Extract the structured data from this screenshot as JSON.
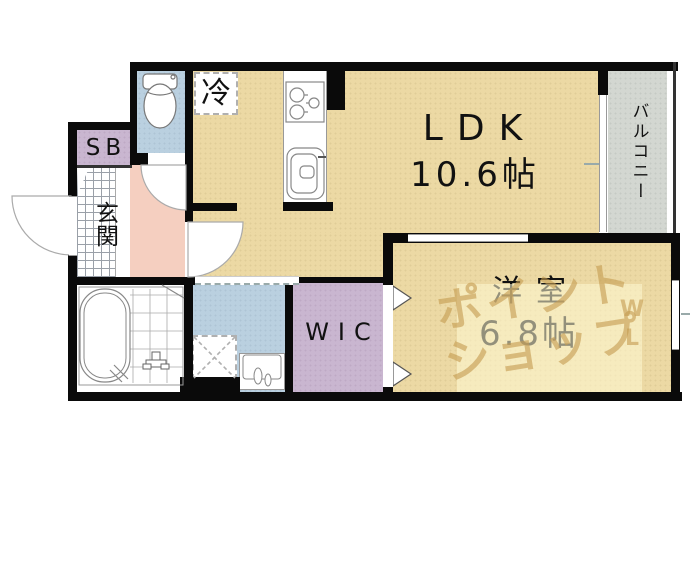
{
  "plan": {
    "rooms": {
      "ldk": {
        "label": "LDK",
        "area": "10.6帖"
      },
      "bedroom": {
        "label": "洋室",
        "area": "6.8帖"
      },
      "balcony": {
        "label": "バルコニー"
      },
      "wic": {
        "label": "WIC"
      },
      "entrance": {
        "label": "玄関"
      },
      "shoe_box": {
        "label": "SB"
      },
      "refrigerator": {
        "label": "冷"
      }
    },
    "watermark": {
      "line1": "ポイント",
      "line2": "ショップ",
      "mark_top": "W",
      "mark_bottom": "L"
    }
  },
  "colors": {
    "beige": "#ecd9a4",
    "gray": "#d3d7d1",
    "blue": "#bad0e0",
    "pink": "#f5cfc0",
    "purple": "#c9b6d0",
    "wall": "#0a0a0a",
    "watermark_text": "#c59c52"
  }
}
